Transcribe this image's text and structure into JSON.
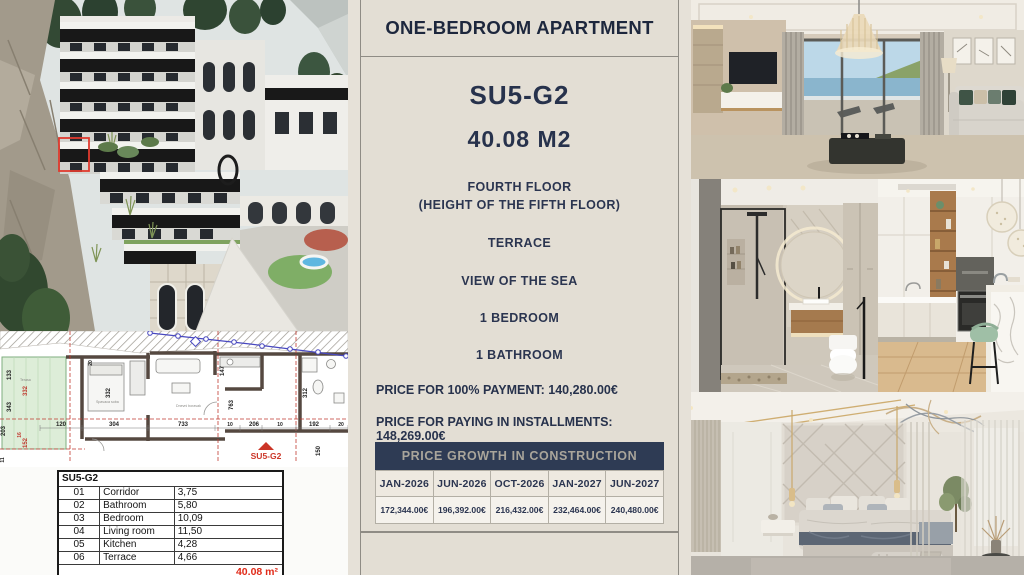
{
  "panel": {
    "header_title": "ONE-BEDROOM APARTMENT",
    "unit_code": "SU5-G2",
    "unit_area": "40.08 M2",
    "floor_line1": "FOURTH FLOOR",
    "floor_line2": "(HEIGHT OF THE FIFTH FLOOR)",
    "features": [
      "TERRACE",
      "VIEW OF THE SEA",
      "1 BEDROOM",
      "1 BATHROOM"
    ],
    "price_full_label": "PRICE FOR 100% PAYMENT:",
    "price_full_value": "140,280.00€",
    "price_inst_label": "PRICE FOR PAYING IN INSTALLMENTS:",
    "price_inst_value": "148,269.00€",
    "growth": {
      "banner": "PRICE GROWTH IN CONSTRUCTION",
      "columns": [
        "JAN-2026",
        "JUN-2026",
        "OCT-2026",
        "JAN-2027",
        "JUN-2027"
      ],
      "values": [
        "172,344.00€",
        "196,392.00€",
        "216,432.00€",
        "232,464.00€",
        "240,480.00€"
      ]
    }
  },
  "left": {
    "room_table": {
      "title": "SU5-G2",
      "rows": [
        {
          "num": "01",
          "name": "Corridor",
          "area": "3,75"
        },
        {
          "num": "02",
          "name": "Bathroom",
          "area": "5,80"
        },
        {
          "num": "03",
          "name": "Bedroom",
          "area": "10,09"
        },
        {
          "num": "04",
          "name": "Living room",
          "area": "11,50"
        },
        {
          "num": "05",
          "name": "Kitchen",
          "area": "4,28"
        },
        {
          "num": "06",
          "name": "Terrace",
          "area": "4,66"
        }
      ],
      "total": "40,08 m²"
    },
    "floorplan": {
      "unit_label": "SU5-G2",
      "room_labels": [
        "Terasa",
        "Spavaca soba",
        "Dnevni boravak"
      ],
      "dims": [
        "133",
        "343",
        "203",
        "332",
        "152",
        "16",
        "120",
        "304",
        "733",
        "206",
        "192",
        "10",
        "10",
        "147",
        "763",
        "312",
        "150",
        "20",
        "20",
        "11"
      ]
    }
  },
  "colors": {
    "panel_bg": "#e3ded4",
    "navy": "#2e3b54",
    "navy_text": "#27324c",
    "red_accent": "#cb3527",
    "banner_text": "#a9a59b"
  }
}
